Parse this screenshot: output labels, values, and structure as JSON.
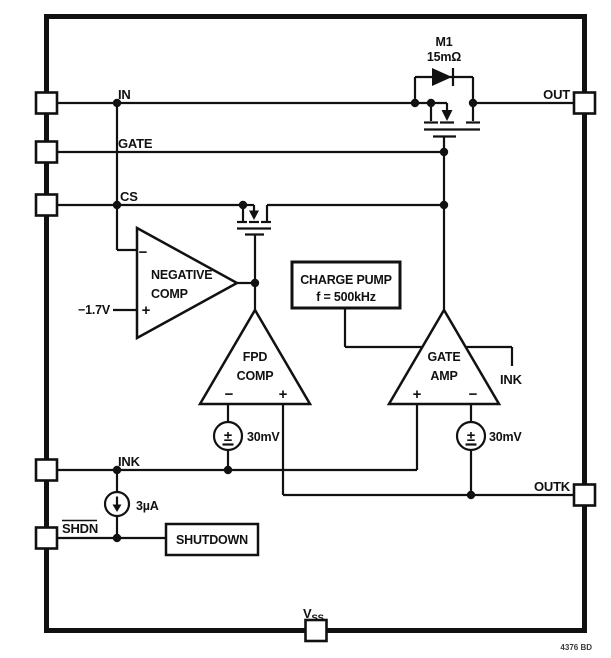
{
  "figure": {
    "footer_ref": "4376 BD",
    "pins": {
      "in": "IN",
      "gate": "GATE",
      "cs": "CS",
      "ink": "INK",
      "shdn": "SHDN",
      "out": "OUT",
      "outk": "OUTK",
      "vss_main": "V",
      "vss_sub": "SS"
    },
    "mosfet_m1": {
      "ref": "M1",
      "rds": "15mΩ"
    },
    "negative_comp": {
      "name_line1": "NEGATIVE",
      "name_line2": "COMP",
      "inverting": "−",
      "noninverting": "+",
      "threshold": "−1.7V"
    },
    "fpd_comp": {
      "name_line1": "FPD",
      "name_line2": "COMP",
      "inverting": "−",
      "noninverting": "+"
    },
    "gate_amp": {
      "name_line1": "GATE",
      "name_line2": "AMP",
      "noninverting": "+",
      "inverting": "−",
      "tap_label": "INK"
    },
    "charge_pump": {
      "name": "CHARGE PUMP",
      "freq": "f = 500kHz"
    },
    "shutdown_block": {
      "name": "SHUTDOWN"
    },
    "offset_left": {
      "value": "30mV",
      "sign": "±"
    },
    "offset_right": {
      "value": "30mV",
      "sign": "±"
    },
    "current_source": {
      "value": "3µA"
    }
  }
}
